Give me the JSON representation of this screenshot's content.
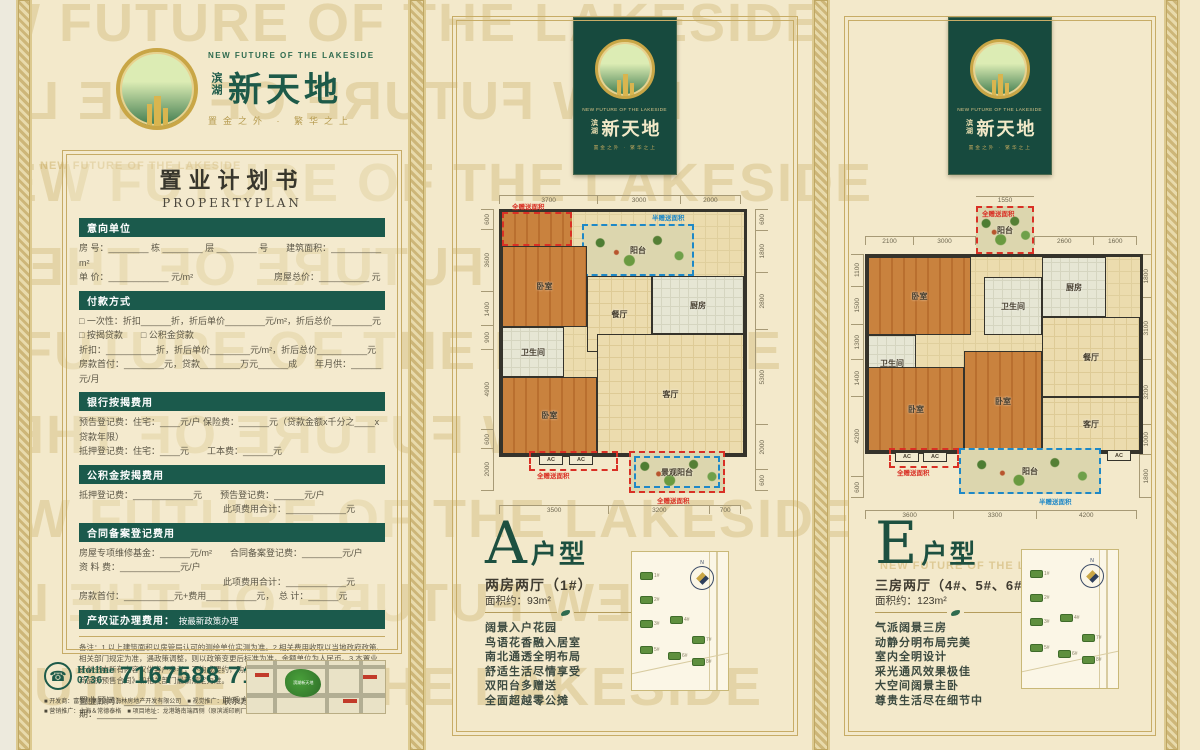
{
  "watermark": "NEW FUTURE OF THE LAKESIDE",
  "brand": {
    "name_prefix": "滨湖",
    "name_main": "新天地",
    "tagline_en": "NEW FUTURE OF THE LAKESIDE",
    "tagline_cn": "置金之外 · 繁华之上"
  },
  "form": {
    "title_cn": "置业计划书",
    "title_en": "PROPERTYPLAN",
    "sections": [
      {
        "title": "意向单位",
        "rows": [
          "房 号：________ 栋 ________ 层 ________ 号　　建筑面积：__________ m²",
          "单 价：____________ 元/m²　　　　　　　　　房屋总价：__________ 元"
        ]
      },
      {
        "title": "付款方式",
        "rows": [
          "□ 一次性：折扣______折，折后单价________元/m²，折后总价________元",
          "□ 按揭贷款　　□ 公积金贷款",
          "折扣：__________折，折后单价________元/m²，折后总价__________元",
          "房款首付：________元，贷款________万元______成　　年月供：______元/月"
        ]
      },
      {
        "title": "银行按揭费用",
        "rows": [
          "预告登记费：住宅：____元/户 保险费：______元（贷款金额x千分之____x贷款年限）",
          "抵押登记费：住宅：____元　　工本费：______元"
        ]
      },
      {
        "title": "公积金按揭费用",
        "rows": [
          "抵押登记费：____________元　　预告登记费：______元/户",
          "　　　　　　　　　　　　　　　　此项费用合计：____________元"
        ]
      },
      {
        "title": "合同备案登记费用",
        "rows": [
          "房屋专项维修基金：______元/m²　　合同备案登记费：________元/户",
          "资 料 费：____________元/户",
          "　　　　　　　　　　　　　　　　此项费用合计：____________元",
          "房款首付：__________元+费用__________元，　总 计：______元"
        ]
      },
      {
        "title": "产权证办理费用：",
        "note": "按最新政策办理",
        "rows": []
      }
    ],
    "remark": "备注：1.以上建筑面积以房管局认可的测绘单位实测为准。2.相关费用收取以当地政府政策、相关部门规定为准，遇政策调整，则以政策变更后标准为准，金额单位为人民币。3.本置业计划书中所有内容仅供客户参考，不构成要约，购房中的权利义务均以双方签订的《常德市商品房预售合同》和相关部门最新规定为准。",
    "consultant_row": "置业顾问：________________　　联系方式：________________　　日期：____________"
  },
  "hotline": {
    "label": "Hotline",
    "code": "0736",
    "numbers": "7167588  7167288"
  },
  "footer": {
    "credits": [
      "■ 开发商：富黎登集团湖南海林房地产开发有限公司　■ 视觉推广：中世锐意",
      "■ 营销推广：上海＆常德泰格　■ 项目地址：龙港路南端西侧（原滨湖印刷厂）"
    ]
  },
  "map": {
    "site_label": "滨湖新天地"
  },
  "legend": {
    "full_gift": "全赠送面积",
    "half_gift": "半赠送面积",
    "ac": "AC"
  },
  "site": {
    "buildings": [
      "1#",
      "2#",
      "3#",
      "4#",
      "5#",
      "6#",
      "7#",
      "8#"
    ]
  },
  "plans": {
    "a": {
      "letter": "A",
      "suffix": "户型",
      "subtitle": "两房两厅（1#）",
      "area": "面积约：93m²",
      "dims_top": [
        "3700",
        "3000",
        "2000"
      ],
      "dims_bottom": [
        "3500",
        "3200",
        "700"
      ],
      "dims_left": [
        "600",
        "3600",
        "1400",
        "900",
        "4900",
        "600",
        "2000"
      ],
      "dims_right": [
        "600",
        "1800",
        "2800",
        "5300",
        "2000",
        "600"
      ],
      "rooms": [
        "入户花园",
        "阳台",
        "卧室",
        "餐厅",
        "厨房",
        "卫生间",
        "卧室",
        "客厅",
        "景观阳台"
      ],
      "features": [
        "阔景入户花园",
        "鸟语花香融入居室",
        "南北通透全明布局",
        "舒适生活尽情享受",
        "双阳台多赠送",
        "全面超越零公摊"
      ]
    },
    "e": {
      "letter": "E",
      "suffix": "户型",
      "subtitle": "三房两厅（4#、5#、6#、7#、8#）",
      "area": "面积约：123m²",
      "balcony_width": "1550",
      "dims_top_left": [
        "2100",
        "3000"
      ],
      "dims_top_right": [
        "2600",
        "1600"
      ],
      "dims_bottom": [
        "3600",
        "3300",
        "4200"
      ],
      "dims_left": [
        "1100",
        "1500",
        "1300",
        "1400",
        "4200",
        "600"
      ],
      "dims_right": [
        "1800",
        "3100",
        "3200",
        "1000",
        "1800"
      ],
      "rooms": [
        "阳台",
        "卧室",
        "卫生间",
        "厨房",
        "餐厅",
        "卫生间",
        "卧室",
        "卧室",
        "客厅",
        "阳台"
      ],
      "features": [
        "气派阔景三房",
        "动静分明布局完美",
        "室内全明设计",
        "采光通风效果极佳",
        "大空间阔景主卧",
        "尊贵生活尽在细节中"
      ]
    }
  }
}
